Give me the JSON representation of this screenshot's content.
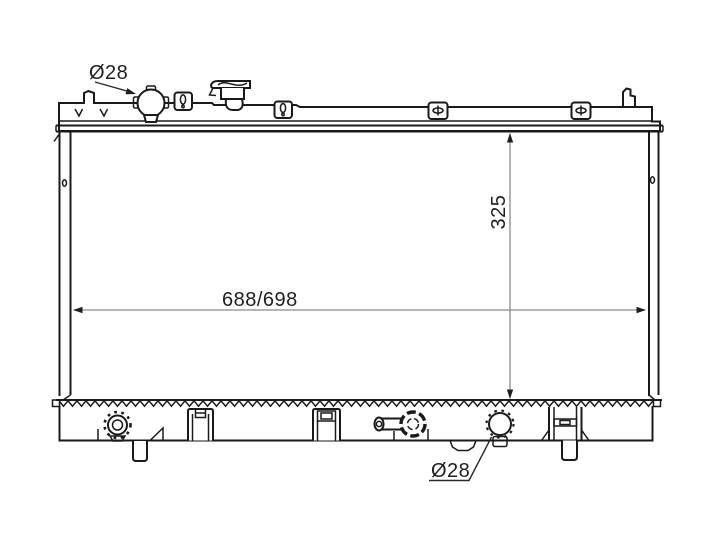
{
  "drawing": {
    "title": "Radiator outline technical drawing",
    "view": "front elevation with top and bottom tanks, core, fittings and mounting brackets",
    "labels": {
      "top_port_diameter": "Ø28",
      "bottom_port_diameter": "Ø28",
      "core_height": "325",
      "core_width": "688/698"
    },
    "colors": {
      "line": "#1a1a1a",
      "dimension_line": "#8a8a8a",
      "text": "#1f1f1f",
      "background": "#ffffff"
    }
  }
}
